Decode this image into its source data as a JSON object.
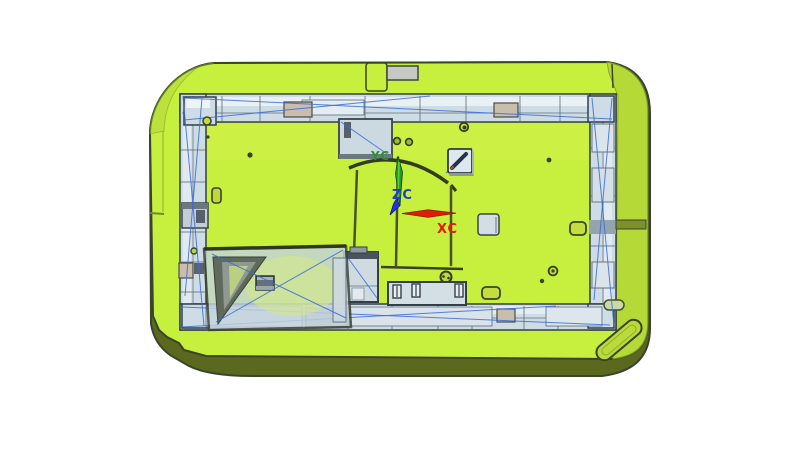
{
  "canvas": {
    "width": 800,
    "height": 452
  },
  "triad": {
    "labels": {
      "x": "XC",
      "y": "YC",
      "z": "ZC"
    }
  },
  "colors": {
    "background": "#ffffff",
    "plate_top": "#c7ef3e",
    "plate_side_dark": "#5a691d",
    "plate_side_mid": "#b2d737",
    "outline_dark": "#3a442c",
    "frame_fill": "#cedce5",
    "frame_light": "#edf3f6",
    "frame_shadow": "#94a4ae",
    "steel_outline": "#323e46",
    "tan_block": "#c9bdae",
    "wire_blue": "#3a6cd8",
    "panel": "#c3d3dc",
    "notch_gray": "#c6c9c3",
    "axis_x": "#e21b07",
    "axis_y": "#2b9431",
    "axis_z": "#2038e0"
  }
}
